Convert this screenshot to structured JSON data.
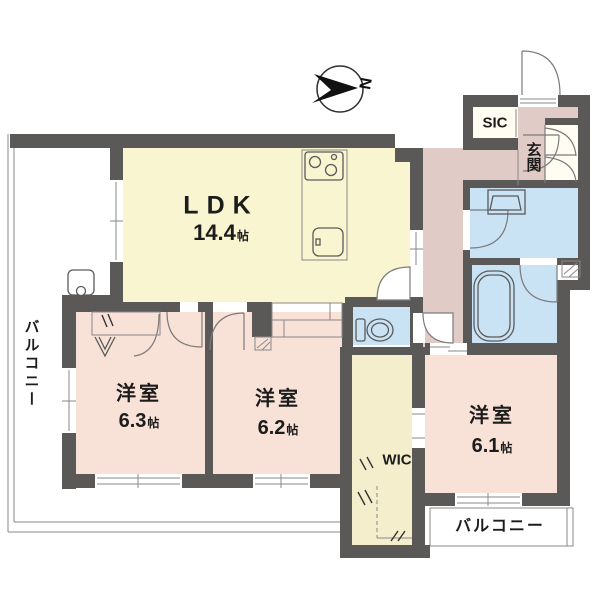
{
  "compass": {
    "label": "N"
  },
  "colors": {
    "wall": "#5b5858",
    "ldk_floor": "#f8f5d0",
    "bedroom_floor": "#f8e1d7",
    "hall_floor": "#e0cbc7",
    "wet_area_floor": "#c9e3f5",
    "wic_floor": "#f4eecd",
    "closet_floor": "#fffdf2",
    "counter": "#f6f3d4",
    "balcony": "#ffffff",
    "line": "#8a8888"
  },
  "rooms": {
    "ldk": {
      "name": "LDK",
      "area": "14.4",
      "unit": "帖"
    },
    "bedroom_63": {
      "name": "洋室",
      "area": "6.3",
      "unit": "帖"
    },
    "bedroom_62": {
      "name": "洋室",
      "area": "6.2",
      "unit": "帖"
    },
    "bedroom_61": {
      "name": "洋室",
      "area": "6.1",
      "unit": "帖"
    },
    "wic": {
      "name": "WIC"
    },
    "sic": {
      "name": "SIC"
    },
    "genkan": {
      "name": "玄関"
    },
    "balcony_left": {
      "name": "バルコニー"
    },
    "balcony_bottom": {
      "name": "バルコニー"
    }
  }
}
